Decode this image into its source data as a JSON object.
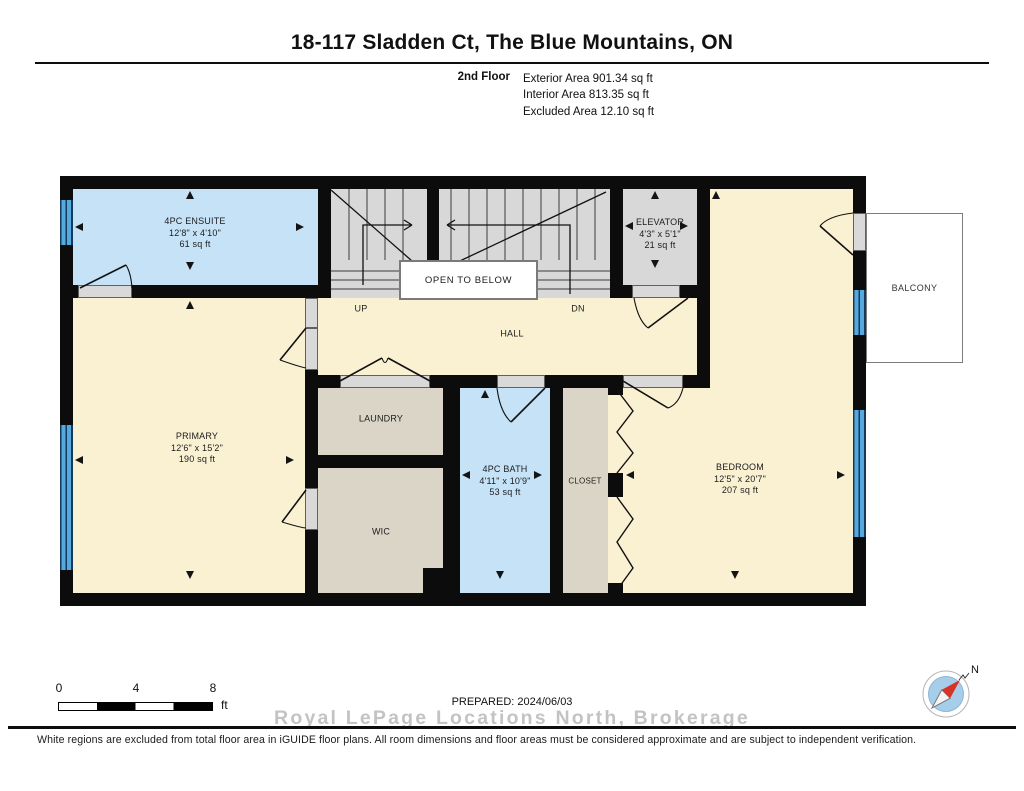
{
  "header": {
    "title": "18-117 Sladden Ct, The Blue Mountains, ON",
    "floor_label": "2nd Floor",
    "areas": [
      "Exterior Area 901.34 sq ft",
      "Interior Area 813.35 sq ft",
      "Excluded Area 12.10 sq ft"
    ]
  },
  "plan": {
    "rooms": {
      "ensuite": {
        "name": "4PC ENSUITE",
        "dims": "12'8\" x 4'10\"",
        "area": "61 sq ft"
      },
      "elevator": {
        "name": "ELEVATOR",
        "dims": "4'3\" x 5'1\"",
        "area": "21 sq ft"
      },
      "primary": {
        "name": "PRIMARY",
        "dims": "12'6\" x 15'2\"",
        "area": "190 sq ft"
      },
      "bath": {
        "name": "4PC BATH",
        "dims": "4'11\" x 10'9\"",
        "area": "53 sq ft"
      },
      "bedroom": {
        "name": "BEDROOM",
        "dims": "12'5\" x 20'7\"",
        "area": "207 sq ft"
      },
      "laundry": {
        "name": "LAUNDRY"
      },
      "wic": {
        "name": "WIC"
      },
      "closet": {
        "name": "CLOSET"
      },
      "hall": {
        "name": "HALL"
      },
      "balcony": {
        "name": "BALCONY"
      }
    },
    "stairs": {
      "up": "UP",
      "down": "DN",
      "open_to_below": "OPEN TO BELOW"
    }
  },
  "footer": {
    "scale": {
      "ticks": [
        "0",
        "4",
        "8"
      ],
      "unit": "ft"
    },
    "prepared": "PREPARED: 2024/06/03",
    "watermark": "Royal LePage Locations North, Brokerage",
    "disclaimer": "White regions are excluded from total floor area in iGUIDE floor plans. All room dimensions and floor areas must be considered approximate and are subject to independent verification.",
    "compass_label": "N"
  },
  "colors": {
    "room_cream": "#FAF1D3",
    "room_blue": "#C5E2F7",
    "room_gray": "#D8D8D8",
    "room_beige": "#DBD5C7",
    "wall": "#0C0C0C",
    "window": "#4FA3D8",
    "compass_red": "#D63426",
    "watermark_gray": "#C7C7C7"
  }
}
